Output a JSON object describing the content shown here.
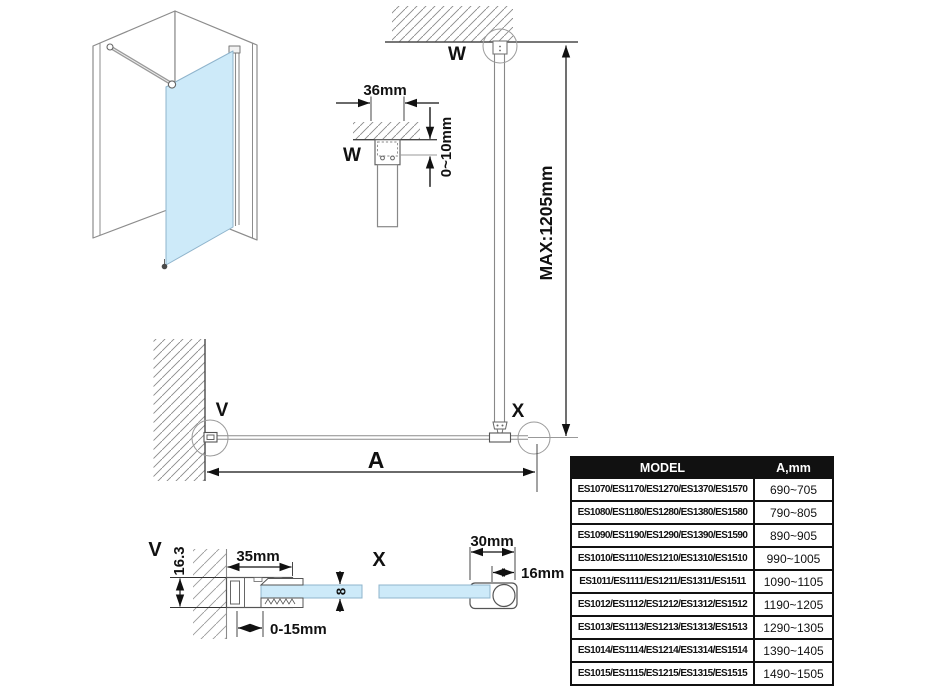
{
  "drawing": {
    "labels": {
      "w_elevation": "W",
      "w_detail": "W",
      "v_plan": "V",
      "x_plan": "X",
      "v_detail": "V",
      "x_detail": "X",
      "a": "A"
    },
    "dims": {
      "bracket_width": "36mm",
      "ceiling_gap": "0~10mm",
      "max_bar_length": "MAX:1205mm",
      "wall_profile_width": "35mm",
      "wall_profile_depth": "16.3",
      "wall_adjustment": "0-15mm",
      "glass_thickness": "8",
      "end_profile_width": "30mm",
      "bar_diameter": "16mm"
    },
    "colors": {
      "glass": "#cdeaf9",
      "line": "#555555",
      "dimension": "#111111"
    }
  },
  "table": {
    "headers": {
      "model": "MODEL",
      "a_mm": "A,mm"
    },
    "rows": [
      {
        "model": "ES1070/ES1170/ES1270/ES1370/ES1570",
        "a": "690~705"
      },
      {
        "model": "ES1080/ES1180/ES1280/ES1380/ES1580",
        "a": "790~805"
      },
      {
        "model": "ES1090/ES1190/ES1290/ES1390/ES1590",
        "a": "890~905"
      },
      {
        "model": "ES1010/ES1110/ES1210/ES1310/ES1510",
        "a": "990~1005"
      },
      {
        "model": "ES1011/ES1111/ES1211/ES1311/ES1511",
        "a": "1090~1105"
      },
      {
        "model": "ES1012/ES1112/ES1212/ES1312/ES1512",
        "a": "1190~1205"
      },
      {
        "model": "ES1013/ES1113/ES1213/ES1313/ES1513",
        "a": "1290~1305"
      },
      {
        "model": "ES1014/ES1114/ES1214/ES1314/ES1514",
        "a": "1390~1405"
      },
      {
        "model": "ES1015/ES1115/ES1215/ES1315/ES1515",
        "a": "1490~1505"
      }
    ]
  }
}
